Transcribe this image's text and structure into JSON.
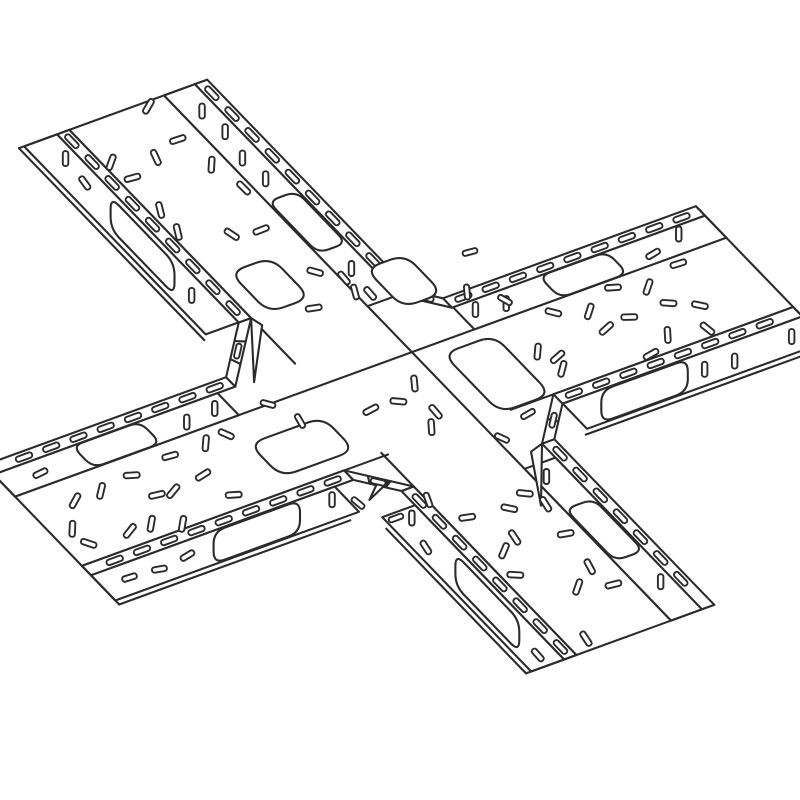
{
  "title": "Cable tray cross fitting - isometric line illustration",
  "canvas": {
    "width": 800,
    "height": 800,
    "background": "#ffffff"
  },
  "style": {
    "line_color": "#2b2b2b",
    "fill_color": "#ffffff",
    "stroke_main": 2.1,
    "stroke_slot": 1.9
  },
  "diagram": {
    "type": "line-art",
    "subject": "4-way perforated cable tray cross junction, isometric view",
    "center": [
      398,
      404
    ],
    "tray_a": {
      "angle_deg": 46,
      "t_levels": [
        -88,
        -76,
        -46,
        46,
        58,
        90,
        95
      ],
      "arm_neg": {
        "name": "nw",
        "length": 405
      },
      "arm_pos": {
        "name": "se",
        "length": 325
      }
    },
    "tray_b": {
      "angle_deg": -20,
      "t_levels": [
        -84,
        -72,
        -44,
        44,
        56,
        88,
        93
      ],
      "arm_neg": {
        "name": "sw",
        "length": 372
      },
      "arm_pos": {
        "name": "ne",
        "length": 385
      }
    },
    "corners": {
      "top": {
        "gap": 26
      },
      "right": {
        "gap": 40
      },
      "bottom": {
        "gap": 36
      },
      "left": {
        "gap": 58
      }
    },
    "flange_slot": {
      "length": 17,
      "width": 5.5,
      "radius": 2.6,
      "spacing": 29
    },
    "wall_slot": {
      "length": 15,
      "width": 5.5,
      "spacing": 31
    },
    "far_cutout": {
      "half_len": 36,
      "half_cross": 15,
      "radius": 13,
      "period": 190
    },
    "near_cutout": {
      "half_len": 46,
      "half_vert": 16,
      "radius": 13,
      "period": 185
    },
    "floor_slot": {
      "length": 16,
      "width": 5.5,
      "grid_s": 37,
      "grid_t": 30,
      "jitter_s": 13,
      "jitter_t": 9
    },
    "floor_cutouts": [
      {
        "tray": "a",
        "cx": 404,
        "cy": 281,
        "ha": 27,
        "hb": 21
      },
      {
        "tray": "a",
        "cx": 270,
        "cy": 285,
        "ha": 28,
        "hb": 22
      },
      {
        "tray": "b",
        "cx": 497,
        "cy": 374,
        "ha": 41,
        "hb": 27
      },
      {
        "tray": "b",
        "cx": 302,
        "cy": 447,
        "ha": 23,
        "hb": 39
      }
    ],
    "extra_slots": [
      [
        344,
        278,
        50
      ],
      [
        355,
        292,
        75
      ],
      [
        470,
        252,
        -15
      ],
      [
        467,
        292,
        85
      ],
      [
        505,
        300,
        30
      ],
      [
        358,
        503,
        40
      ],
      [
        396,
        518,
        -20
      ],
      [
        428,
        500,
        70
      ],
      [
        502,
        438,
        25
      ],
      [
        528,
        414,
        -30
      ],
      [
        268,
        404,
        15
      ],
      [
        300,
        421,
        60
      ]
    ],
    "seed": 11
  }
}
